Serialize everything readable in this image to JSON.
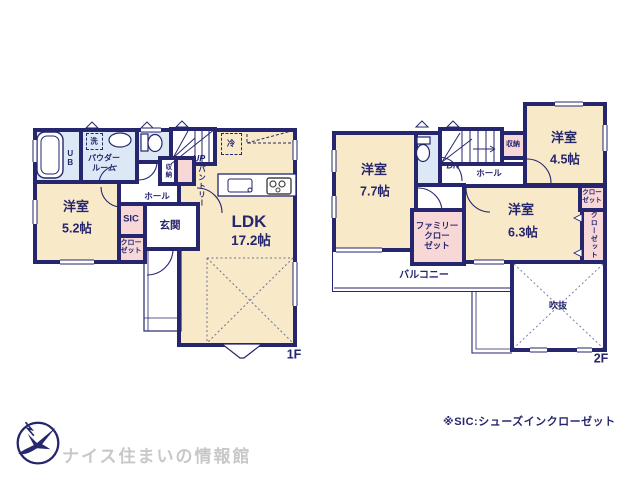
{
  "colors": {
    "wall": "#26266e",
    "room_cream": "#f8e9c8",
    "wet_blue": "#dce8f5",
    "closet_pink": "#f8d8d6",
    "logo_gray": "#c8c8c8"
  },
  "floor1": {
    "floor_label": "1F",
    "ldk": {
      "name": "LDK",
      "area": "17.2帖"
    },
    "bedroom": {
      "name": "洋室",
      "area": "5.2帖"
    },
    "entrance": "玄関",
    "sic": "SIC",
    "closet": "クロー\nゼット",
    "hall": "ホール",
    "storage": "収納",
    "pantry": "パントリー",
    "up": "UP",
    "fridge": "冷",
    "washer": "洗",
    "powder_room": "パウダー\nルーム",
    "unit_bath": "UB"
  },
  "floor2": {
    "floor_label": "2F",
    "bedroom_a": {
      "name": "洋室",
      "area": "7.7帖"
    },
    "bedroom_b": {
      "name": "洋室",
      "area": "4.5帖"
    },
    "bedroom_c": {
      "name": "洋室",
      "area": "6.3帖"
    },
    "family_closet": "ファミリー\nクロー\nゼット",
    "closet_a": "クロー\nゼット",
    "closet_b": "クローゼット",
    "storage": "収納",
    "hall": "ホール",
    "down": "DN",
    "balcony": "バルコニー",
    "void": "吹抜"
  },
  "footer": {
    "brand": "ナイス住まいの情報館",
    "note": "※SIC:シューズインクローゼット"
  }
}
